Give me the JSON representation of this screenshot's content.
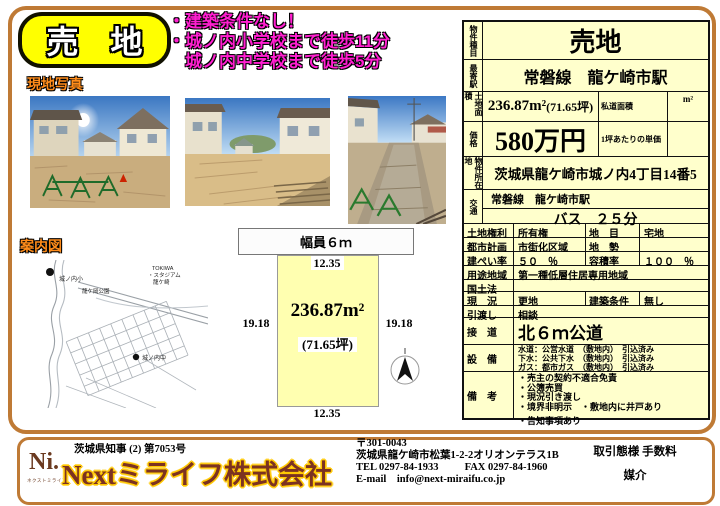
{
  "banner": {
    "title": "売　地"
  },
  "highlights": {
    "line1": "・建築条件なし！",
    "line2": "・城ノ内小学校まで徒歩11分",
    "line3": "　城ノ内中学校まで徒歩5分"
  },
  "photos": {
    "label": "現地写真"
  },
  "map": {
    "label": "案内図",
    "school_elem": "城ノ内小",
    "park": "龍ケ岡公園",
    "stadium1": "TOKIWA",
    "stadium2": "・スタジアム",
    "stadium3": "龍ケ崎",
    "school_jhs": "城ノ内中"
  },
  "plot": {
    "road": "幅員６ｍ",
    "side_top": "12.35",
    "side_bottom": "12.35",
    "side_left": "19.18",
    "side_right": "19.18",
    "area": "236.87m²",
    "area_tsubo": "(71.65坪)"
  },
  "table": {
    "property_type_label": "物件種目",
    "property_type": "売地",
    "station_label": "最寄駅",
    "station": "常磐線　龍ケ崎市駅",
    "land_area_label": "土地面積",
    "land_area": "236.87m²",
    "land_area_tsubo": "(71.65坪)",
    "private_road_label": "私道面積",
    "private_road_unit": "m²",
    "price_label": "価格",
    "price": "580万円",
    "unit_price_label": "1坪あたりの単価",
    "unit_price": "",
    "location_label": "物件所在地",
    "location": "茨城県龍ケ崎市城ノ内4丁目14番5",
    "access_label": "交通",
    "access_line": "常磐線　龍ケ崎市駅",
    "access_bus": "バス　２５分",
    "rows": {
      "land_right_label": "土地権利",
      "land_right": "所有権",
      "land_category_label": "地　目",
      "land_category": "宅地",
      "city_plan_label": "都市計画",
      "city_plan": "市街化区域",
      "terrain_label": "地　勢",
      "terrain": "",
      "bcr_label": "建ぺい率",
      "bcr": "５０　％",
      "far_label": "容積率",
      "far": "１００　％",
      "zoning_label": "用途地域",
      "zoning": "第一種低層住居専用地域",
      "national_land_label": "国土法",
      "national_land": "",
      "status_label": "現　況",
      "status": "更地",
      "building_cond_label": "建築条件",
      "building_cond": "無し",
      "handover_label": "引渡し",
      "handover": "相談",
      "road_contact_label": "接　道",
      "road_contact": "北６ｍ公道",
      "utilities_label": "設　備",
      "utility1": "水道：公営水道　（敷地内）　引込済み",
      "utility2": "下水：公共下水　（敷地内）　引込済み",
      "utility3": "ガス：都市ガス　（敷地内）　引込済み",
      "remarks_label": "備　考",
      "remark1": "・売主の契約不適合免責",
      "remark2": "・公簿売買",
      "remark3": "・現況引き渡し",
      "remark4": "・境界非明示　・敷地内に井戸あり",
      "remark5": "・告知事項あり"
    }
  },
  "footer": {
    "license": "茨城県知事 (2) 第7053号",
    "logo": "Ni.",
    "logo_sub": "ネクストミライフ",
    "company": "Nextミライフ株式会社",
    "postal": "〒301-0043",
    "address": "茨城県龍ケ崎市松葉1-2-2オリオンテラス1B",
    "tel": "TEL 0297-84-1933",
    "fax": "FAX 0297-84-1960",
    "email": "E-mail　info@next-miraifu.co.jp",
    "dealing_label": "取引態様 手数料",
    "dealing": "媒介"
  },
  "colors": {
    "accent_border": "#bf7a35",
    "banner_yellow": "#ffff00",
    "highlight_magenta": "#ff1fd0",
    "table_bg": "#ffffcc",
    "plot_bg": "#ffffb0",
    "company_brown": "#7b3222"
  }
}
